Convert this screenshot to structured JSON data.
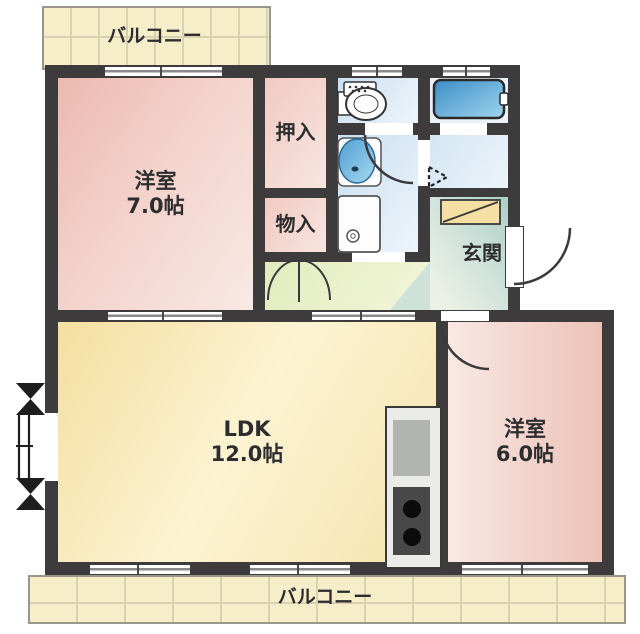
{
  "title": "apartment-floor-plan",
  "labels": {
    "balcony_top": "バルコニー",
    "balcony_bottom": "バルコニー",
    "yoshitsu7_name": "洋室",
    "yoshitsu7_size": "7.0帖",
    "oshiire": "押入",
    "monoire": "物入",
    "genkan": "玄関",
    "ldk_name": "LDK",
    "ldk_size": "12.0帖",
    "yoshitsu6_name": "洋室",
    "yoshitsu6_size": "6.0帖"
  },
  "fixtures": {
    "toilet": "toilet-fixture",
    "washbasin": "round-washbasin",
    "washer_pan": "washing-machine-pan",
    "bathtub": "bathtub",
    "kitchen": "kitchen-counter-sink-stove",
    "shoe_cabinet": "shoe-cabinet",
    "bay_window": "bay-window",
    "entrance_door": "entrance-door-swing",
    "folding_door": "folding-door-arrow",
    "double_closet_doors": "double-swing-closet-doors"
  },
  "colors": {
    "wall": "#3d3b3c",
    "room_pink": "#f0c9c1",
    "room_yellow": "#f8e8b8",
    "hallway_green": "#e9f0ca",
    "wet_area_blue": "#d8e9f5",
    "genkan_teal": "#c3dad2",
    "balcony_cream": "#f5eec9",
    "bathtub_blue": "#4a9ad0"
  }
}
